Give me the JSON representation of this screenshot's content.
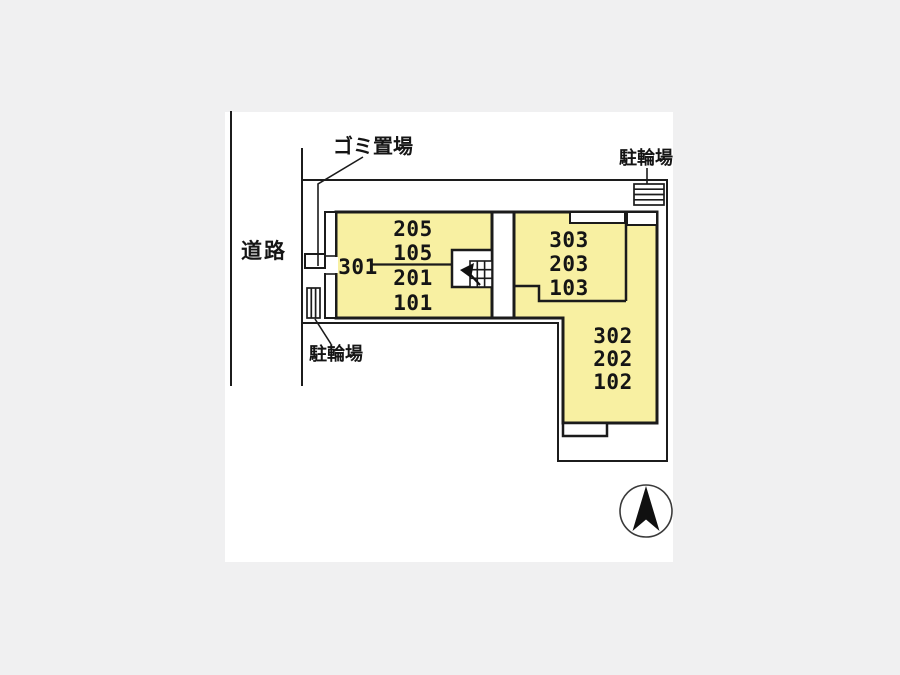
{
  "plan": {
    "road_label": "道路",
    "garbage_area_label": "ゴミ置場",
    "bicycle_parking_left_label": "駐輪場",
    "bicycle_parking_right_label": "駐輪場",
    "units": {
      "u301": "301",
      "u205": "205",
      "u105": "105",
      "u201": "201",
      "u101": "101",
      "u303": "303",
      "u203": "203",
      "u103": "103",
      "u302": "302",
      "u202": "202",
      "u102": "102"
    },
    "colors": {
      "background": "#f0f0f1",
      "canvas": "#ffffff",
      "building_fill": "#f8f0a2",
      "line": "#1b1b1b"
    }
  }
}
